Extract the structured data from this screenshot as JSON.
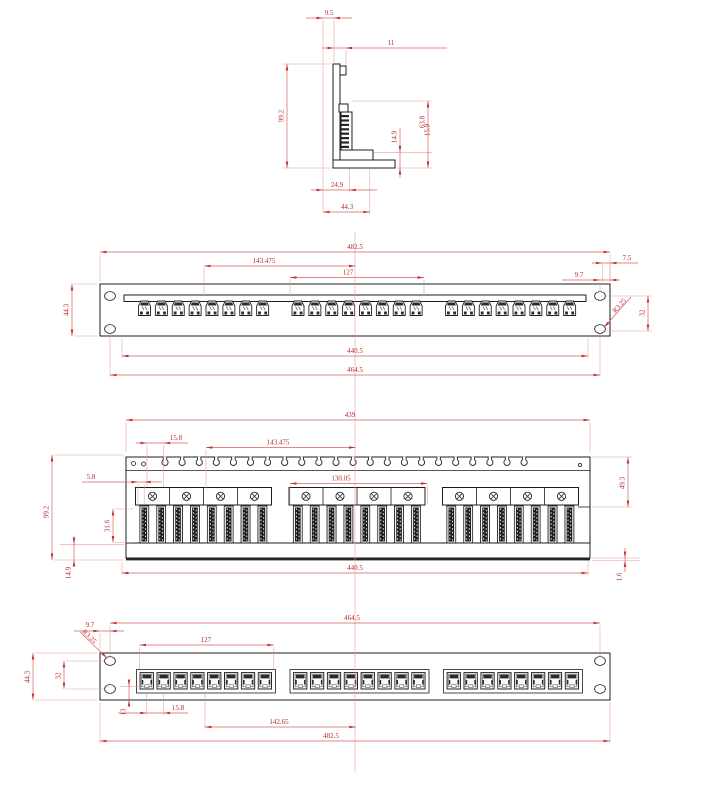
{
  "drawing": {
    "background": "#ffffff",
    "line_color": "#1c1c1c",
    "dimension_color": "#c03333"
  },
  "views": {
    "side": {
      "label": "side-section-view",
      "dims": {
        "d95": "9.5",
        "d11": "11",
        "d992": "99.2",
        "d149": "14.9",
        "d638": "63.8",
        "d159": "15.9",
        "d249": "24.9",
        "d443": "44.3"
      }
    },
    "front_top": {
      "label": "front-view-upper",
      "ports": {
        "groups": 3,
        "per_group": 8
      },
      "dims": {
        "d4825": "482.5",
        "d143": "143.475",
        "d127": "127",
        "d443": "44.3",
        "d97": "9.7",
        "d75": "7.5",
        "dr": "R3.25",
        "d32": "32",
        "d4405": "440.5",
        "d4645": "464.5"
      }
    },
    "rear": {
      "label": "rear-view",
      "idc": {
        "groups": 3,
        "blocks_per_group": 8,
        "screws_per_group": 4,
        "comb_slots": 22
      },
      "dims": {
        "d439": "439",
        "d158": "15.8",
        "d143": "143.475",
        "d58": "5.8",
        "d130": "130.05",
        "d316": "31.6",
        "d992": "99.2",
        "d149": "14.9",
        "d493": "49.3",
        "d16": "1.6",
        "d4405": "440.5"
      }
    },
    "front_bottom": {
      "label": "front-view-lower",
      "ports": {
        "groups": 3,
        "per_group": 8
      },
      "dims": {
        "d4645": "464.5",
        "d97": "9.7",
        "dr": "R3.25",
        "d127": "127",
        "d32": "32",
        "d443": "44.3",
        "d13": "13",
        "d158": "15.8",
        "d14265": "142.65",
        "d4825": "482.5"
      }
    }
  }
}
